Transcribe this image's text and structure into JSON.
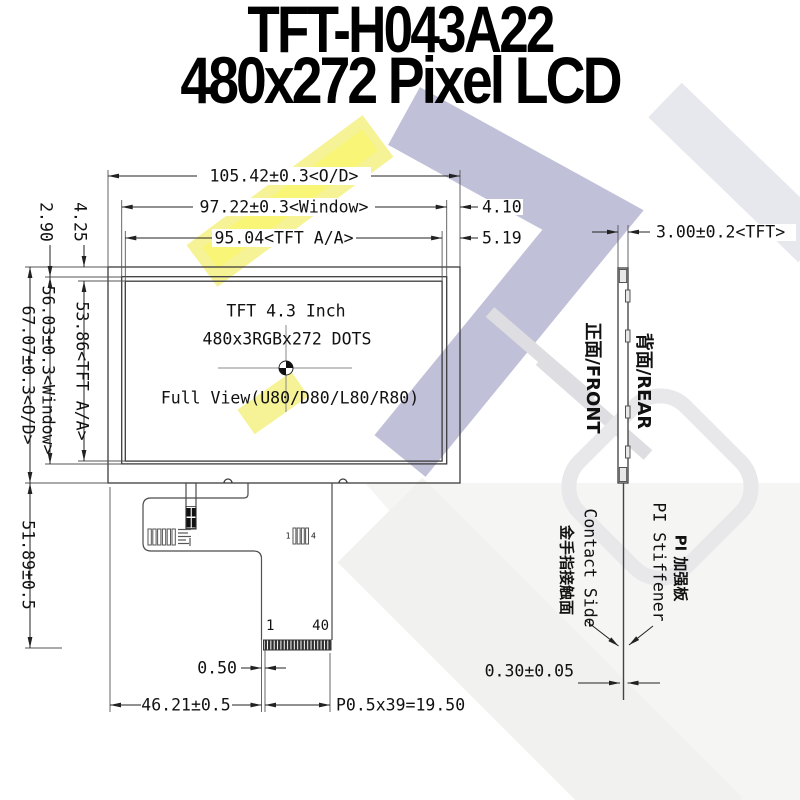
{
  "title": {
    "line1": "TFT-H043A22",
    "line2": "480x272 Pixel LCD"
  },
  "front_view": {
    "display_text": {
      "line1": "TFT 4.3 Inch",
      "line2": "480x3RGBx272 DOTS",
      "line3": "Full View(U80/D80/L80/R80)"
    },
    "dimensions": {
      "outline_width": "105.42±0.3<O/D>",
      "window_width": "97.22±0.3<Window>",
      "active_width": "95.04<TFT A/A>",
      "window_side_margin": "4.10",
      "active_side_margin": "5.19",
      "active_top_margin": "4.25",
      "window_top_margin": "2.90",
      "outline_height": "67.07±0.3<O/D>",
      "window_height": "56.03±0.3<Window>",
      "active_height": "53.86<TFT A/A>",
      "fpc_length": "51.89±0.5",
      "pin1_offset": "0.50",
      "connector_offset": "46.21±0.5",
      "pin_pitch": "P0.5x39=19.50"
    },
    "connector": {
      "pin_first": "1",
      "pin_last": "40"
    },
    "fiducial": {
      "first": "1",
      "last": "4"
    }
  },
  "side_view": {
    "thickness": "3.00±0.2<TFT>",
    "front_label": "正面/FRONT",
    "rear_label": "背面/REAR",
    "contact_label_cn": "金手指接触面",
    "contact_label_en": "Contact Side",
    "stiffener_label_en": "PI Stiffener",
    "stiffener_label_cn": "PI 加强板",
    "fpc_thickness": "0.30±0.05"
  },
  "colors": {
    "line": "#3c3c3c",
    "text": "#111111",
    "watermark_yellow": "#f5f183",
    "watermark_lavender": "#b5b5d3",
    "watermark_gray": "#dcdce4"
  }
}
